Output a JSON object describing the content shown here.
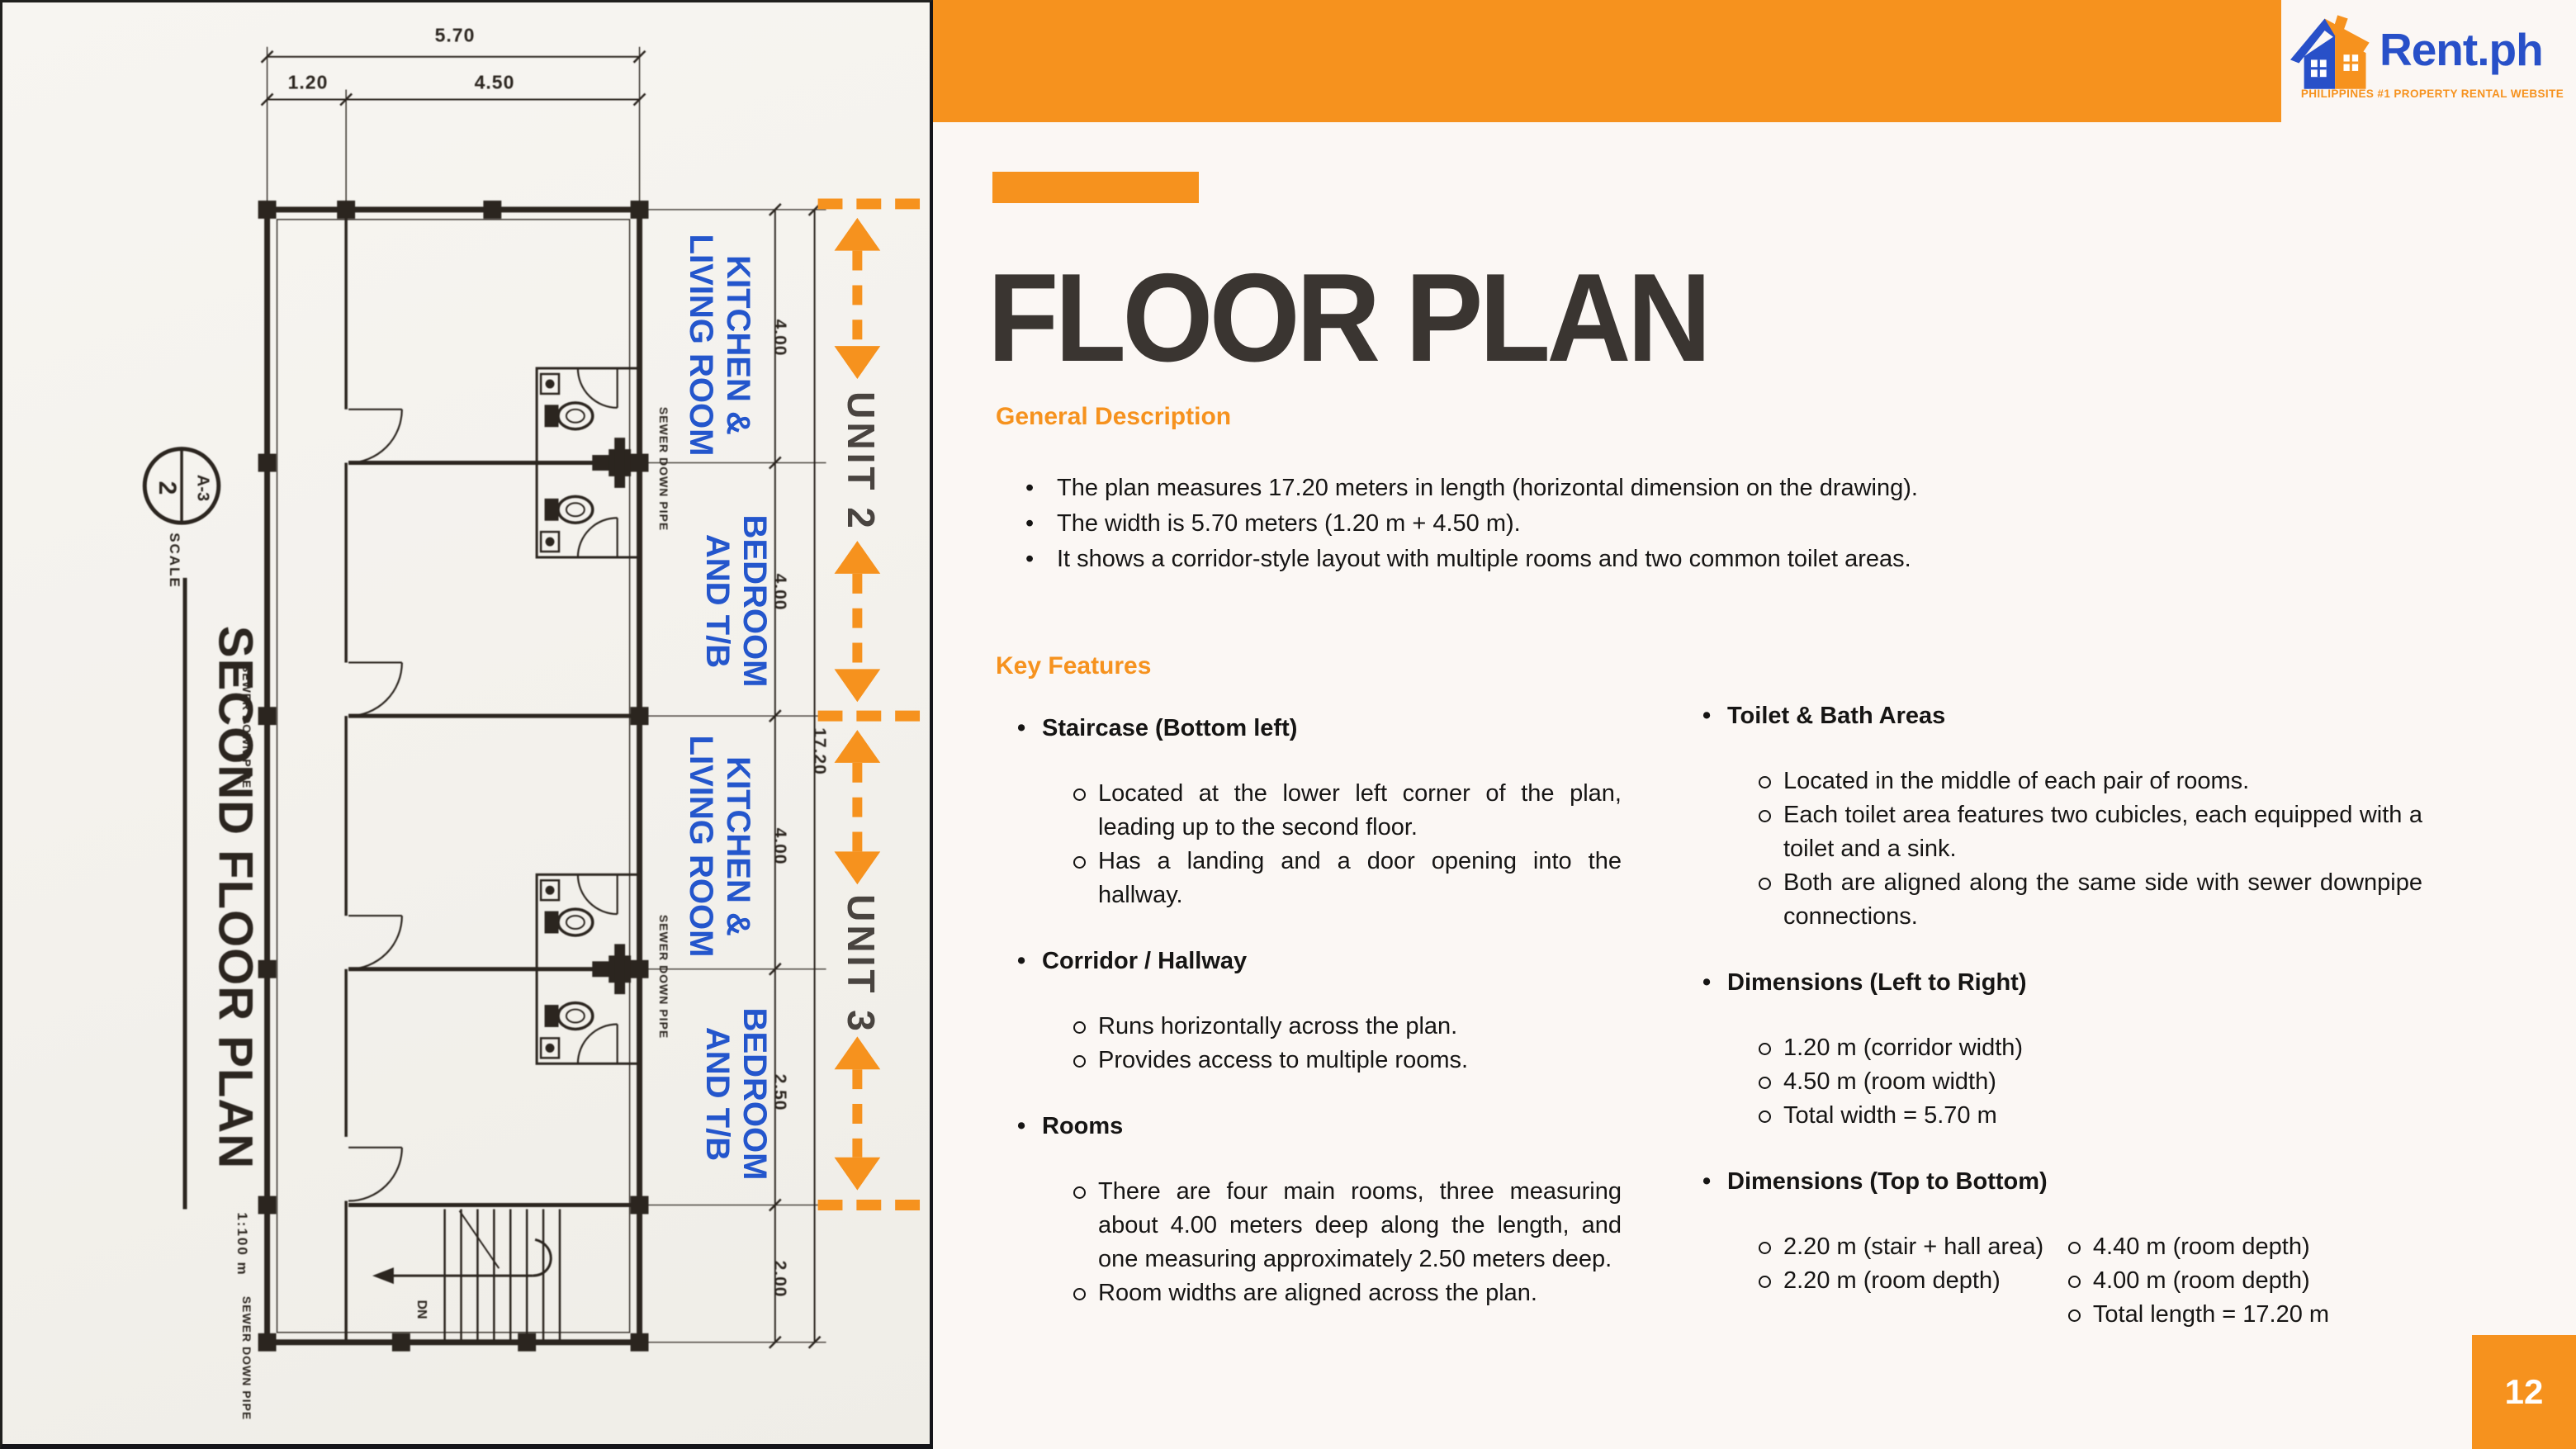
{
  "colors": {
    "orange": "#F6921E",
    "blue": "#2456CC",
    "ink": "#2B251F",
    "title_dark": "#3A3531",
    "logo_blue": "#2850C8"
  },
  "logo": {
    "brand": "Rent.ph",
    "tagline": "PHILIPPINES #1 PROPERTY RENTAL WEBSITE",
    "icon": "house-icon"
  },
  "slide": {
    "title": "FLOOR PLAN",
    "page_number": "12"
  },
  "general": {
    "heading": "General Description",
    "bullets": [
      "The plan measures 17.20 meters in length (horizontal dimension on the drawing).",
      "The width is 5.70 meters (1.20 m + 4.50 m).",
      "It shows a corridor-style layout with multiple rooms and two common toilet areas."
    ]
  },
  "key": {
    "heading": "Key Features",
    "staircase": {
      "title": "Staircase (Bottom left)",
      "subs": [
        "Located at the lower left corner of the plan, leading up to the second floor.",
        "Has a landing and a door opening into the hallway."
      ]
    },
    "corridor": {
      "title": "Corridor / Hallway",
      "subs": [
        "Runs horizontally across the plan.",
        "Provides access to multiple rooms."
      ]
    },
    "rooms": {
      "title": "Rooms",
      "subs": [
        "There are four main rooms, three measuring about 4.00 meters deep along the length, and one measuring approximately 2.50 meters deep.",
        "Room widths are aligned across the plan."
      ]
    },
    "toilet": {
      "title": "Toilet & Bath Areas",
      "subs": [
        "Located in the middle of each pair of rooms.",
        "Each toilet area features two cubicles, each equipped with a toilet and a sink.",
        "Both are aligned along the same side with sewer downpipe connections."
      ]
    },
    "dims_lr": {
      "title": "Dimensions (Left to Right)",
      "subs": [
        "1.20 m (corridor width)",
        "4.50 m (room width)",
        "Total width = 5.70 m"
      ]
    },
    "dims_tb": {
      "title": "Dimensions (Top to Bottom)",
      "col_a": [
        "2.20 m (stair + hall area)",
        "2.20 m (room depth)"
      ],
      "col_b": [
        "4.40 m (room depth)",
        "4.00 m (room depth)",
        "Total length = 17.20 m"
      ]
    }
  },
  "plan": {
    "sheet_title": "SECOND FLOOR PLAN",
    "scale_label": "SCALE",
    "scale_value": "1:100 m",
    "detail_number": "2",
    "detail_sheet": "A-3",
    "top_dims": {
      "total": "5.70",
      "corridor": "1.20",
      "room": "4.50"
    },
    "right_dims": {
      "segments": [
        "4.00",
        "4.00",
        "4.00",
        "2.50",
        "2.00"
      ],
      "total": "17.20"
    },
    "room_labels": [
      {
        "l1": "KITCHEN &",
        "l2": "LIVING ROOM"
      },
      {
        "l1": "BEDROOM",
        "l2": "AND T/B"
      },
      {
        "l1": "KITCHEN &",
        "l2": "LIVING ROOM"
      },
      {
        "l1": "BEDROOM",
        "l2": "AND T/B"
      }
    ],
    "units": [
      "UNIT 2",
      "UNIT 3"
    ],
    "sewer_label": "SEWER DOWN PIPE",
    "stair_label": "DN"
  }
}
